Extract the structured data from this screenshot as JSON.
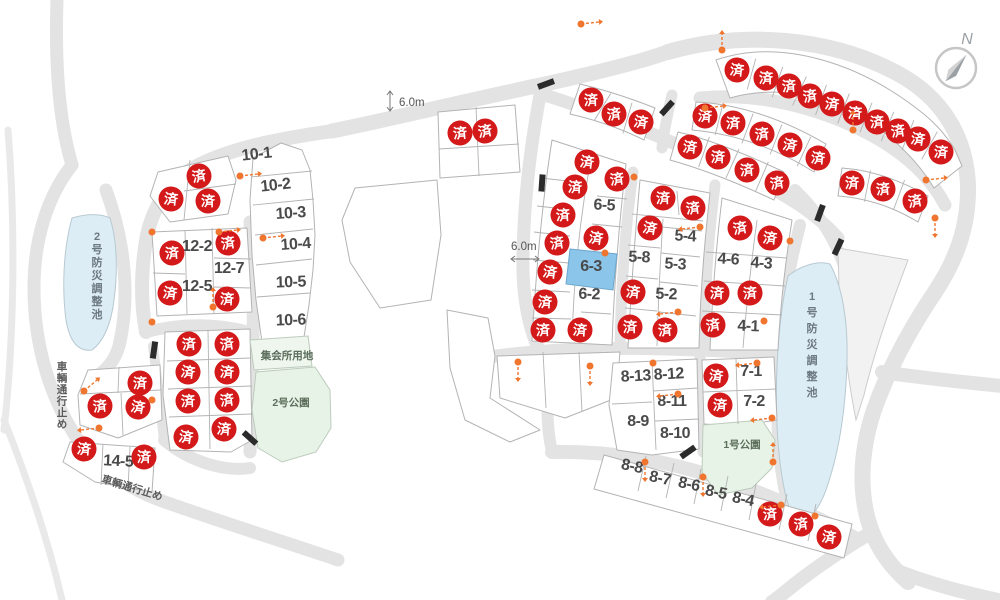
{
  "map_colors": {
    "road": "#e3e3e3",
    "road_thin": "#e9e9e9",
    "lot_fill": "#ffffff",
    "lot_stroke": "#b3b3b3",
    "sold_red": "#d31919",
    "sold_text": "#ffffff",
    "highlight_blue": "#8cc5ea",
    "pond_fill": "#ddedf6",
    "pond_stroke": "#b8c9d2",
    "park_fill": "#e7f3e7",
    "meeting_fill": "#eef6ee",
    "park_stroke": "#bccbbc",
    "reserve_fill": "#f2f2f2",
    "reserve_stroke": "#cccccc",
    "marker_orange": "#f0752e",
    "barrier_black": "#2b2b2b",
    "compass_gray": "#9aa0a4"
  },
  "sold_label": "済",
  "highlighted_lot": {
    "id": "6-3",
    "x": 591,
    "y": 271
  },
  "available_lots": [
    {
      "id": "10-1",
      "x": 257,
      "y": 159,
      "rot": -6
    },
    {
      "id": "10-2",
      "x": 276,
      "y": 190,
      "rot": -6
    },
    {
      "id": "10-3",
      "x": 291,
      "y": 218,
      "rot": -4
    },
    {
      "id": "10-4",
      "x": 296,
      "y": 249,
      "rot": -4
    },
    {
      "id": "10-5",
      "x": 291,
      "y": 287,
      "rot": -2
    },
    {
      "id": "10-6",
      "x": 291,
      "y": 325,
      "rot": -2
    },
    {
      "id": "12-2",
      "x": 197,
      "y": 251,
      "rot": 0
    },
    {
      "id": "12-7",
      "x": 229,
      "y": 273,
      "rot": 0
    },
    {
      "id": "12-5",
      "x": 197,
      "y": 291,
      "rot": 0
    },
    {
      "id": "14-5",
      "x": 118,
      "y": 466,
      "rot": 3
    },
    {
      "id": "6-5",
      "x": 604,
      "y": 210,
      "rot": 3
    },
    {
      "id": "6-2",
      "x": 589,
      "y": 299,
      "rot": 2
    },
    {
      "id": "5-8",
      "x": 639,
      "y": 262,
      "rot": 2
    },
    {
      "id": "5-4",
      "x": 685,
      "y": 241,
      "rot": 3
    },
    {
      "id": "5-3",
      "x": 675,
      "y": 269,
      "rot": 3
    },
    {
      "id": "5-2",
      "x": 666,
      "y": 299,
      "rot": 2
    },
    {
      "id": "4-6",
      "x": 728,
      "y": 264,
      "rot": 4
    },
    {
      "id": "4-3",
      "x": 761,
      "y": 268,
      "rot": 4
    },
    {
      "id": "4-1",
      "x": 748,
      "y": 331,
      "rot": 2
    },
    {
      "id": "7-1",
      "x": 751,
      "y": 376,
      "rot": 0
    },
    {
      "id": "7-2",
      "x": 754,
      "y": 406,
      "rot": 0
    },
    {
      "id": "8-13",
      "x": 636,
      "y": 381,
      "rot": -3
    },
    {
      "id": "8-12",
      "x": 669,
      "y": 379,
      "rot": -3
    },
    {
      "id": "8-11",
      "x": 672,
      "y": 406,
      "rot": 0
    },
    {
      "id": "8-9",
      "x": 638,
      "y": 426,
      "rot": 0
    },
    {
      "id": "8-10",
      "x": 675,
      "y": 438,
      "rot": 0
    },
    {
      "id": "8-8",
      "x": 631,
      "y": 471,
      "rot": 12
    },
    {
      "id": "8-7",
      "x": 659,
      "y": 483,
      "rot": 12
    },
    {
      "id": "8-6",
      "x": 688,
      "y": 489,
      "rot": 12
    },
    {
      "id": "8-5",
      "x": 715,
      "y": 497,
      "rot": 12
    },
    {
      "id": "8-4",
      "x": 742,
      "y": 504,
      "rot": 12
    }
  ],
  "sold_lots": [
    [
      199,
      176
    ],
    [
      171,
      199
    ],
    [
      208,
      201
    ],
    [
      172,
      253
    ],
    [
      228,
      243
    ],
    [
      170,
      293
    ],
    [
      227,
      299
    ],
    [
      189,
      344
    ],
    [
      227,
      344
    ],
    [
      188,
      372
    ],
    [
      227,
      372
    ],
    [
      188,
      401
    ],
    [
      227,
      400
    ],
    [
      186,
      437
    ],
    [
      224,
      429
    ],
    [
      140,
      383
    ],
    [
      100,
      406
    ],
    [
      138,
      407
    ],
    [
      84,
      449
    ],
    [
      144,
      457
    ],
    [
      460,
      133
    ],
    [
      485,
      131
    ],
    [
      737,
      70
    ],
    [
      766,
      78
    ],
    [
      789,
      86
    ],
    [
      810,
      96
    ],
    [
      832,
      104
    ],
    [
      855,
      113
    ],
    [
      877,
      122
    ],
    [
      898,
      131
    ],
    [
      918,
      139
    ],
    [
      941,
      152
    ],
    [
      591,
      100
    ],
    [
      614,
      114
    ],
    [
      641,
      122
    ],
    [
      705,
      116
    ],
    [
      733,
      123
    ],
    [
      762,
      134
    ],
    [
      790,
      145
    ],
    [
      818,
      158
    ],
    [
      852,
      183
    ],
    [
      883,
      189
    ],
    [
      915,
      201
    ],
    [
      690,
      147
    ],
    [
      718,
      157
    ],
    [
      747,
      170
    ],
    [
      777,
      183
    ],
    [
      587,
      162
    ],
    [
      575,
      187
    ],
    [
      563,
      215
    ],
    [
      557,
      243
    ],
    [
      550,
      272
    ],
    [
      545,
      302
    ],
    [
      543,
      330
    ],
    [
      617,
      179
    ],
    [
      596,
      238
    ],
    [
      580,
      330
    ],
    [
      663,
      198
    ],
    [
      693,
      208
    ],
    [
      650,
      228
    ],
    [
      633,
      292
    ],
    [
      630,
      327
    ],
    [
      665,
      330
    ],
    [
      740,
      228
    ],
    [
      770,
      238
    ],
    [
      717,
      293
    ],
    [
      750,
      293
    ],
    [
      713,
      325
    ],
    [
      716,
      376
    ],
    [
      720,
      405
    ],
    [
      770,
      514
    ],
    [
      801,
      524
    ],
    [
      829,
      537
    ]
  ],
  "areas": [
    {
      "name": "集会所用地",
      "x": 287,
      "y": 359
    },
    {
      "name": "2号公園",
      "x": 291,
      "y": 406
    },
    {
      "name": "1号公園",
      "x": 742,
      "y": 448
    }
  ],
  "ponds": [
    {
      "name": "2号防災調整池",
      "x": 97,
      "y": 240,
      "dy": 13
    },
    {
      "name": "1号防災調整池",
      "x": 812,
      "y": 300,
      "dy": 16
    }
  ],
  "road_notes": [
    {
      "text": "車輌通行止め",
      "x": 62,
      "y": 370,
      "vertical": true,
      "dy": 11.5
    },
    {
      "text": "車輌通行止め",
      "x": 101,
      "y": 482,
      "vertical": false,
      "rot": 17
    }
  ],
  "measurements": [
    {
      "text": "6.0m",
      "x": 399,
      "y": 106,
      "arrow": "v",
      "ax": 390,
      "ay": 101
    },
    {
      "text": "6.0m",
      "x": 511,
      "y": 250,
      "arrow": "h",
      "ax": 525,
      "ay": 259
    }
  ],
  "compass": {
    "label": "N"
  },
  "view_markers": [
    {
      "x": 240,
      "y": 176,
      "dir": "right"
    },
    {
      "x": 263,
      "y": 238,
      "dir": "right"
    },
    {
      "x": 152,
      "y": 232,
      "dir": "dot"
    },
    {
      "x": 219,
      "y": 232,
      "dir": "right"
    },
    {
      "x": 213,
      "y": 307,
      "dir": "up"
    },
    {
      "x": 152,
      "y": 322,
      "dir": "dot"
    },
    {
      "x": 84,
      "y": 391,
      "dir": "upright"
    },
    {
      "x": 99,
      "y": 428,
      "dir": "left"
    },
    {
      "x": 152,
      "y": 400,
      "dir": "dot"
    },
    {
      "x": 581,
      "y": 24,
      "dir": "right"
    },
    {
      "x": 722,
      "y": 50,
      "dir": "up"
    },
    {
      "x": 705,
      "y": 108,
      "dir": "right"
    },
    {
      "x": 634,
      "y": 177,
      "dir": "dot"
    },
    {
      "x": 605,
      "y": 253,
      "dir": "dot"
    },
    {
      "x": 700,
      "y": 227,
      "dir": "left"
    },
    {
      "x": 678,
      "y": 312,
      "dir": "left"
    },
    {
      "x": 790,
      "y": 241,
      "dir": "dot"
    },
    {
      "x": 764,
      "y": 321,
      "dir": "dot"
    },
    {
      "x": 757,
      "y": 363,
      "dir": "left"
    },
    {
      "x": 772,
      "y": 418,
      "dir": "left"
    },
    {
      "x": 653,
      "y": 363,
      "dir": "dot"
    },
    {
      "x": 678,
      "y": 394,
      "dir": "left"
    },
    {
      "x": 645,
      "y": 462,
      "dir": "down"
    },
    {
      "x": 703,
      "y": 477,
      "dir": "down"
    },
    {
      "x": 773,
      "y": 462,
      "dir": "up"
    },
    {
      "x": 781,
      "y": 505,
      "dir": "left"
    },
    {
      "x": 815,
      "y": 516,
      "dir": "dot"
    },
    {
      "x": 926,
      "y": 180,
      "dir": "right"
    },
    {
      "x": 853,
      "y": 130,
      "dir": "up"
    },
    {
      "x": 935,
      "y": 218,
      "dir": "down"
    },
    {
      "x": 518,
      "y": 362,
      "dir": "down"
    },
    {
      "x": 590,
      "y": 366,
      "dir": "down"
    }
  ]
}
